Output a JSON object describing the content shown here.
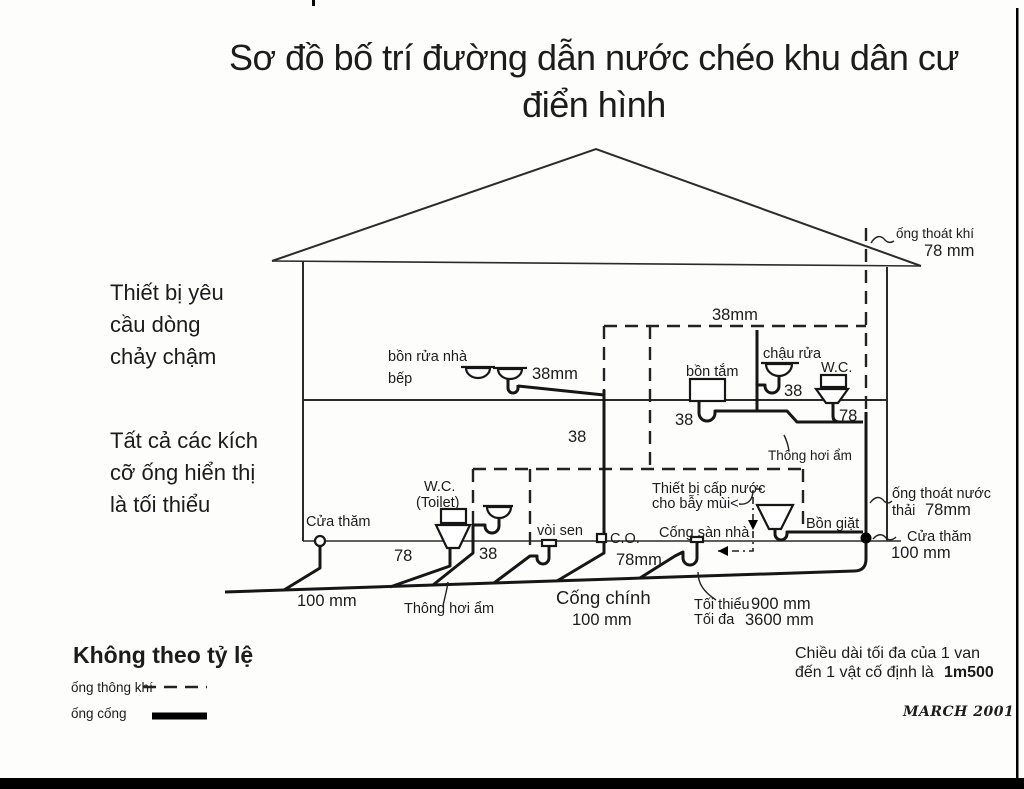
{
  "title": {
    "line1": "Sơ đồ  bố trí đường dẫn nước chéo khu dân cư",
    "line2": "điển hình"
  },
  "side_notes": {
    "slow_flow": [
      "Thiết bị yêu",
      "cầu dòng",
      "chảy chậm"
    ],
    "min_size": [
      "Tất cả các kích",
      "cỡ ống hiển thị",
      "là tối thiểu"
    ]
  },
  "upper_floor": {
    "kitchen_sink": [
      "bồn rửa nhà",
      "bếp"
    ],
    "kitchen_pipe_size": "38mm",
    "vent_size": "38mm",
    "bathtub": "bồn tắm",
    "basin": "chậu rửa",
    "wc": "W.C.",
    "basin_size": "38",
    "tub_size": "38",
    "wc_size": "78",
    "stack_size": "38",
    "wet_vent": "Thông hơi ẩm"
  },
  "lower_floor": {
    "cleanout": "Cửa thăm",
    "wc": "W.C.",
    "toilet": "(Toilet)",
    "shower": "vòi sen",
    "co": "C.O.",
    "toilet_size": "78",
    "lav_size": "38",
    "trap_primer": [
      "Thiết bị cấp nước",
      "cho bẫy mùi<"
    ],
    "floor_drain": "Cống sàn nhà",
    "floor_drain_size": "78mm",
    "laundry": "Bồn giặt",
    "wet_vent": "Thông hơi ẩm",
    "exit_size": "100 mm",
    "main_sewer": "Cống chính",
    "main_sewer_size": "100 mm",
    "min_label": "Tối thiểu",
    "min_value": "900 mm",
    "max_label": "Tối đa",
    "max_value": "3600 mm"
  },
  "right_side": {
    "vent_pipe": "ống thoát khí",
    "vent_pipe_size": "78 mm",
    "waste_pipe": [
      "ống thoát nước",
      "thải"
    ],
    "waste_pipe_size": "78mm",
    "cleanout": "Cửa thăm",
    "cleanout_size": "100 mm"
  },
  "legend": {
    "not_to_scale": "Không theo tỷ lệ",
    "vent_line": "ống thông khí",
    "sewer_line": "ống cống"
  },
  "footer": {
    "note_line1": "Chiều dài tối đa của 1 van",
    "note_line2": "đến 1 vật cố định là",
    "note_value": "1m500",
    "date": "MARCH 2001"
  }
}
